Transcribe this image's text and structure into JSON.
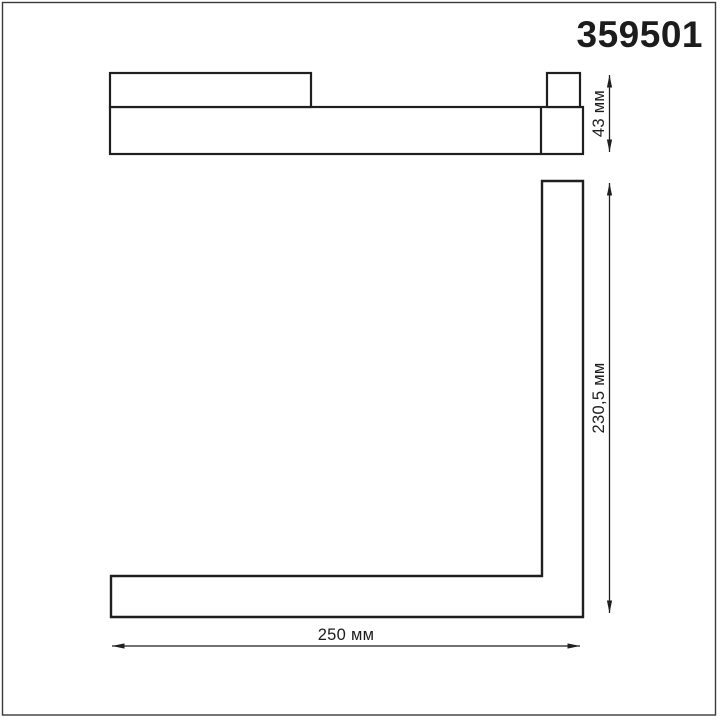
{
  "header": {
    "article_number": "359501"
  },
  "drawing": {
    "side_view": {
      "height_dim_label": "43 мм"
    },
    "front_view": {
      "height_dim_label": "230,5 мм",
      "width_dim_label": "250 мм"
    }
  },
  "colors": {
    "line": "#1f1f1f",
    "text": "#1c1c1c",
    "border": "#3a3a3a",
    "background": "#ffffff"
  }
}
